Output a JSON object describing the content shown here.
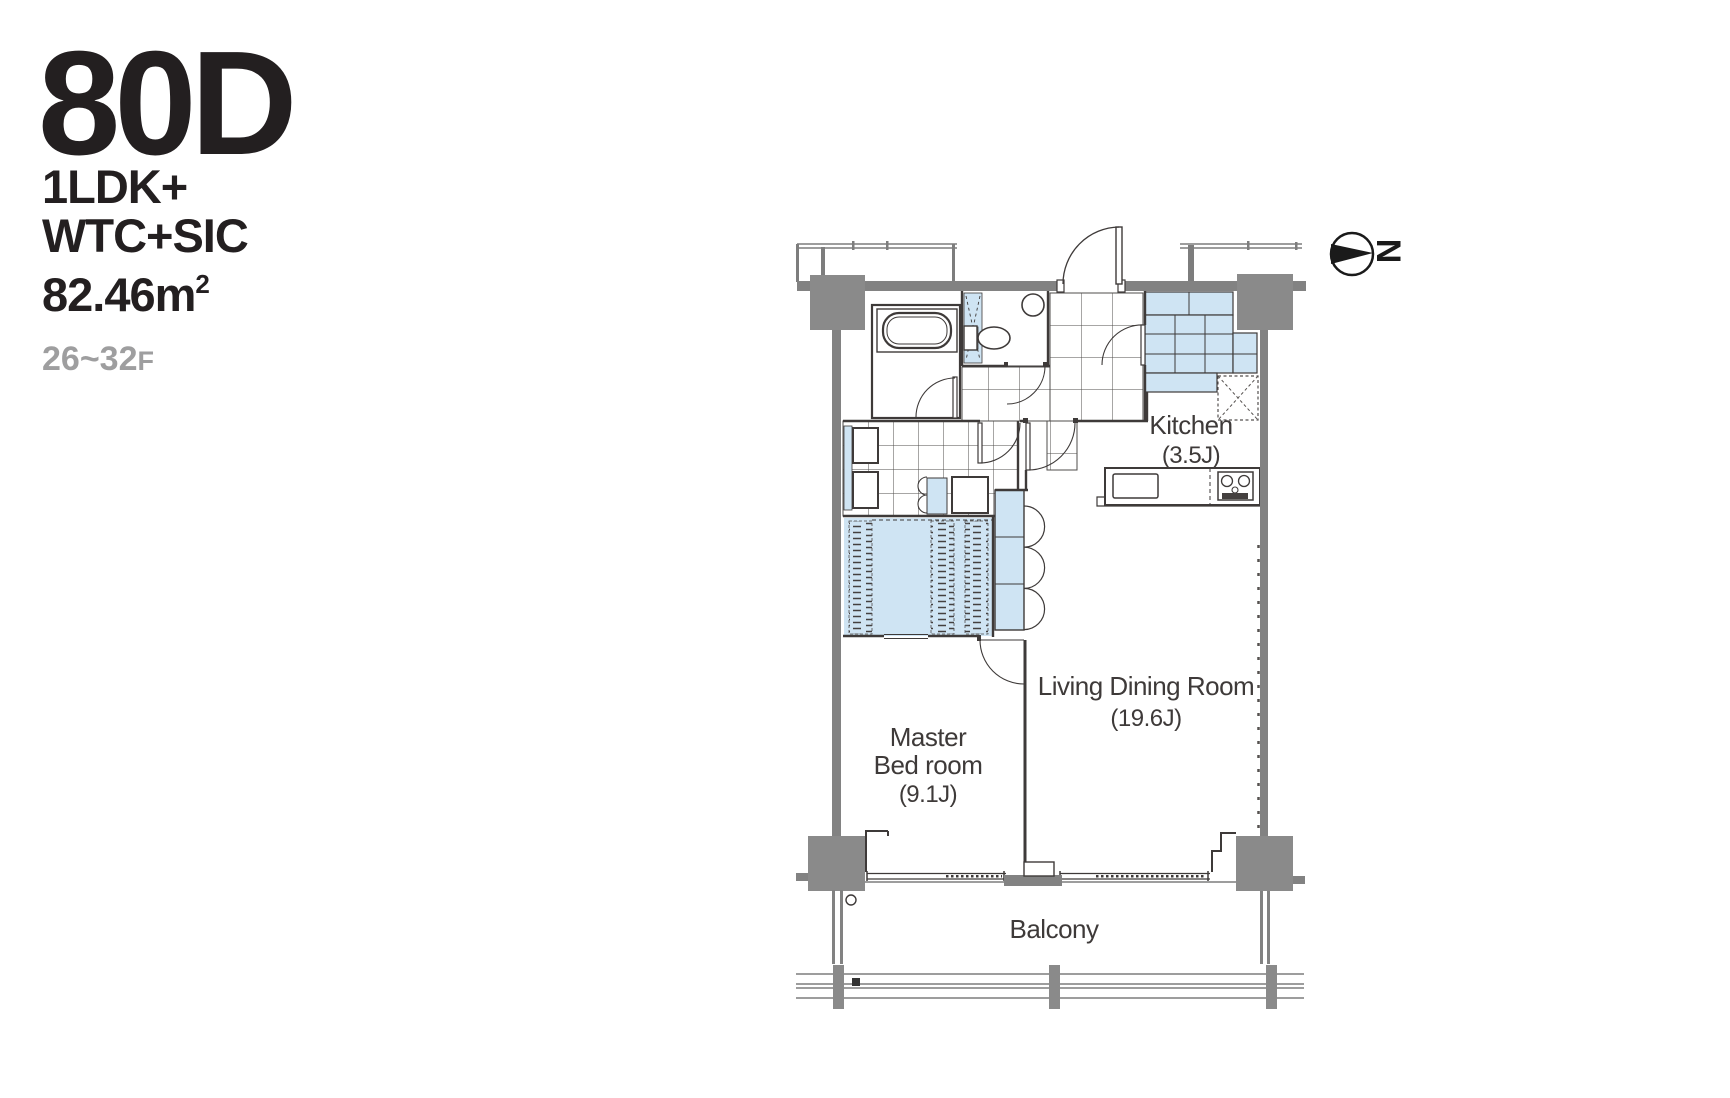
{
  "header": {
    "plan_code": "80D",
    "plan_type": [
      "1LDK+",
      "WTC+SIC"
    ],
    "area": "82.46m",
    "area_superscript": "2",
    "floor_range": "26~32",
    "floor_suffix": "F"
  },
  "plan": {
    "labels": {
      "kitchen_name": "Kitchen",
      "kitchen_size": "(3.5J)",
      "living_name": "Living Dining Room",
      "living_size": "(19.6J)",
      "master_line1": "Master",
      "master_line2": "Bed room",
      "master_size": "(9.1J)",
      "balcony": "Balcony",
      "compass": "N"
    },
    "colors": {
      "highlight_blue": "#cfe4f3",
      "structure_gray": "#828282",
      "column_gray": "#8a8a8a",
      "line_dark": "#3e3a39",
      "header_black": "#231f20",
      "muted_gray": "#9e9e9f"
    }
  }
}
